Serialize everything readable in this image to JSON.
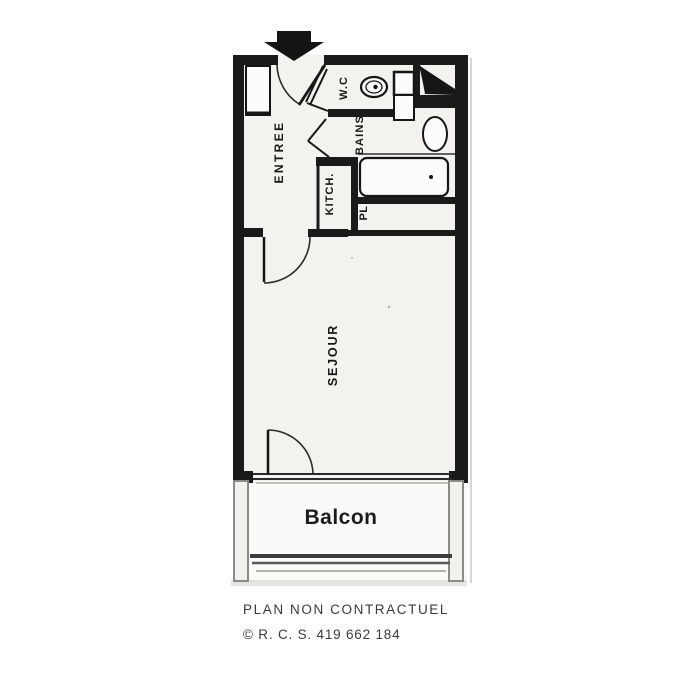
{
  "plan": {
    "type": "apartment-floor-plan",
    "rooms": {
      "entree": {
        "label": "ENTREE"
      },
      "wc": {
        "label": "W.C"
      },
      "bains": {
        "label": "BAINS"
      },
      "kitchen": {
        "label": "KITCH."
      },
      "closet": {
        "label": "PL"
      },
      "sejour": {
        "label": "SEJOUR"
      },
      "balcony": {
        "label": "Balcon"
      }
    },
    "fixtures": [
      "entrance-arrow-icon",
      "entrance-door-swing",
      "wardrobe",
      "toilet-icon",
      "washbasin-icon",
      "bathtub-icon",
      "duct-shaft-icon",
      "sejour-door-swing",
      "balcony-door-swing",
      "window-band",
      "balcony-railing"
    ],
    "colors": {
      "wall": "#1a1a1a",
      "paper": "#f3f2ef",
      "line": "#2a2a2a",
      "scan_edge": "#cfcfc9"
    }
  },
  "footer": {
    "disclaimer": "PLAN NON CONTRACTUEL",
    "registration": "© R. C. S. 419 662 184"
  }
}
